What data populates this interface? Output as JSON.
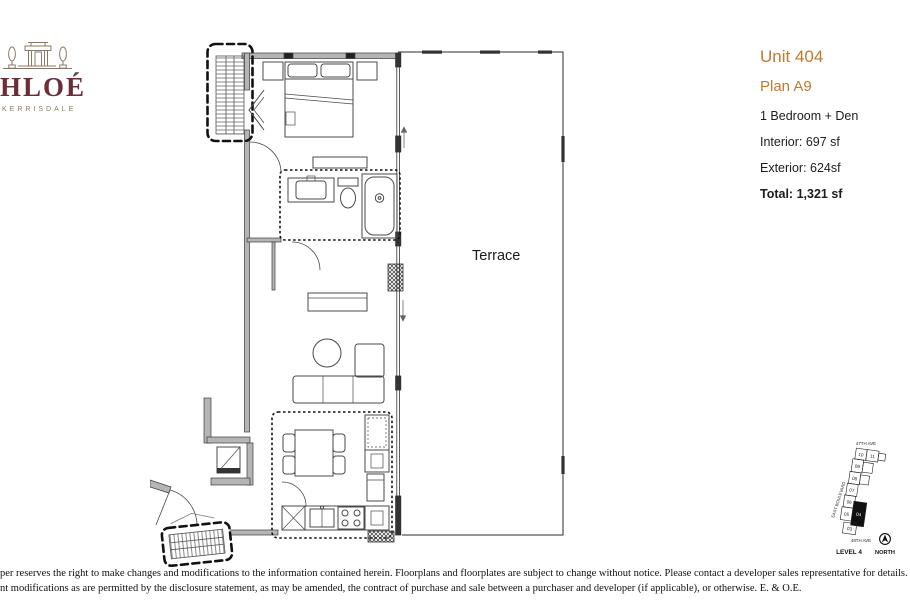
{
  "brand": {
    "logo_text": "HLOÉ",
    "logo_subtext": "KERRISDALE",
    "brand_color": "#6D2C3A",
    "art_color": "#8D7963"
  },
  "unit_info": {
    "unit": "Unit 404",
    "plan": "Plan A9",
    "type": "1 Bedroom + Den",
    "interior": "Interior: 697 sf",
    "exterior": "Exterior: 624sf",
    "total": "Total: 1,321 sf",
    "accent_color": "#C0792F"
  },
  "floor_plan": {
    "terrace_label": "Terrace"
  },
  "keyplan": {
    "street_top": "47TH AVE",
    "street_bottom": "48TH AVE",
    "street_left": "EAST BOULEVARD",
    "level_label": "LEVEL 4",
    "north_label": "NORTH",
    "units": [
      "10",
      "11",
      "09",
      "08",
      "07",
      "06",
      "05",
      "04",
      "03"
    ],
    "highlighted_unit": "04"
  },
  "disclaimer": {
    "line1": "per reserves the right to make changes and modifications to the information contained herein.  Floorplans and floorplates are subject to change without notice. Please contact a developer sales representative for details. The developer may also make such further",
    "line2": "nt modifications as are permitted by the disclosure statement, as may be amended, the contract of purchase and sale between a purchaser and developer (if applicable), or otherwise. E. & O.E."
  }
}
